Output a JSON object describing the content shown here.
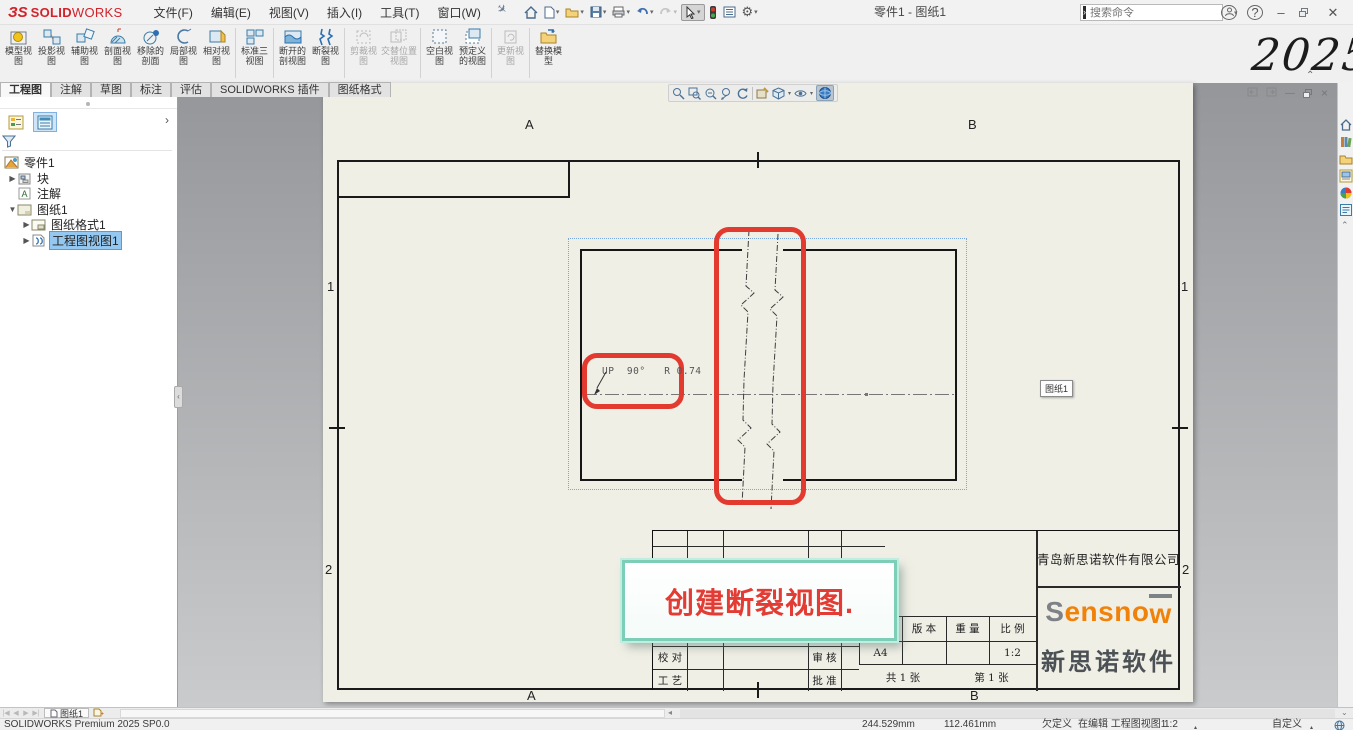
{
  "title_bar": {
    "app_name_bold": "SOLID",
    "app_name_light": "WORKS",
    "menus": [
      "文件(F)",
      "编辑(E)",
      "视图(V)",
      "插入(I)",
      "工具(T)",
      "窗口(W)"
    ],
    "document_title": "零件1 - 图纸1",
    "search": {
      "placeholder": "搜索命令"
    },
    "help_glyph": "?"
  },
  "watermark": "2025",
  "command_manager": {
    "buttons": [
      {
        "label": "模型视图"
      },
      {
        "label": "投影视图"
      },
      {
        "label": "辅助视图"
      },
      {
        "label": "剖面视图"
      },
      {
        "label": "移除的剖面"
      },
      {
        "label": "局部视图"
      },
      {
        "label": "相对视图"
      },
      {
        "label": "标准三视图"
      },
      {
        "label": "断开的剖视图"
      },
      {
        "label": "断裂视图"
      },
      {
        "label": "剪裁视图"
      },
      {
        "label": "交替位置视图"
      },
      {
        "label": "空白视图"
      },
      {
        "label": "预定义的视图"
      },
      {
        "label": "更新视图"
      },
      {
        "label": "替换模型"
      }
    ]
  },
  "ribbon_tabs": [
    {
      "label": "工程图"
    },
    {
      "label": "注解"
    },
    {
      "label": "草图"
    },
    {
      "label": "标注"
    },
    {
      "label": "评估"
    },
    {
      "label": "SOLIDWORKS 插件"
    },
    {
      "label": "图纸格式"
    }
  ],
  "feature_tree": {
    "root": "零件1",
    "items": [
      {
        "label": "块"
      },
      {
        "label": "注解"
      },
      {
        "label": "图纸1"
      },
      {
        "label": "图纸格式1"
      },
      {
        "label": "工程图视图1"
      }
    ]
  },
  "drawing": {
    "zones": {
      "top": [
        "A",
        "B"
      ],
      "bottom": [
        "A",
        "B"
      ],
      "left": [
        "1",
        "2"
      ],
      "right": [
        "1",
        "2"
      ]
    },
    "view_annotation": "UP  90°   R 0.74",
    "tooltip": "图纸1",
    "callout": "创建断裂视图."
  },
  "title_block": {
    "company": "青岛新思诺软件有限公司",
    "logo_s": "S",
    "logo_mid": "ensno",
    "logo_w": "w",
    "logo_cn": "新思诺软件",
    "headers": [
      "图 幅",
      "版 本",
      "重 量",
      "比 例"
    ],
    "sheet_size": "A4",
    "scale": "1:2",
    "total_sheets": "共 1 张",
    "sheet_no": "第 1 张",
    "rows": {
      "proof": "校 对",
      "review": "审 核",
      "process": "工 艺",
      "approve": "批 准"
    }
  },
  "sheet_bar": {
    "tab": "图纸1"
  },
  "status_bar": {
    "left": "SOLIDWORKS Premium 2025 SP0.0",
    "coord_x": "244.529mm",
    "coord_y": "112.461mm",
    "state": "欠定义",
    "editing": "在编辑 工程图视图1",
    "scale": "1:2",
    "custom": "自定义"
  }
}
